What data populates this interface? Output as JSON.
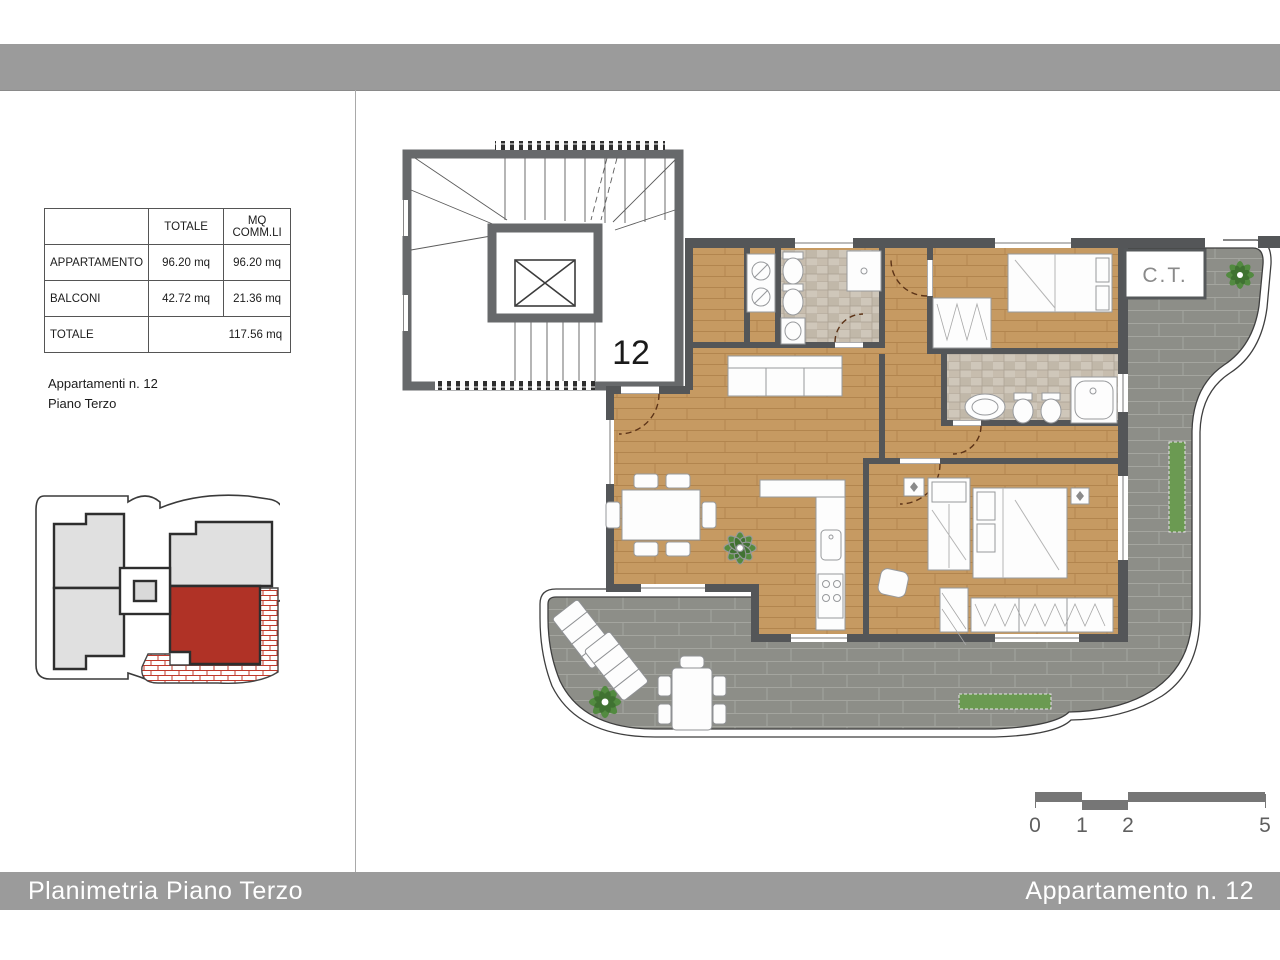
{
  "left_panel": {
    "area_table": {
      "col_headers": [
        "",
        "TOTALE",
        "MQ COMM.LI"
      ],
      "rows": [
        {
          "label": "APPARTAMENTO",
          "totale": "96.20 mq",
          "comm": "96.20 mq"
        },
        {
          "label": "BALCONI",
          "totale": "42.72 mq",
          "comm": "21.36 mq"
        },
        {
          "label": "TOTALE",
          "totale_comm": "117.56 mq"
        }
      ]
    },
    "notes": {
      "line1": "Appartamenti n. 12",
      "line2": "Piano Terzo"
    }
  },
  "plan": {
    "unit_label": "12",
    "ct_label": "C.T.",
    "scale_bar": {
      "labels": [
        "0",
        "1",
        "2",
        "5"
      ]
    }
  },
  "footer": {
    "left": "Planimetria Piano Terzo",
    "right": "Appartamento n. 12"
  },
  "colors": {
    "title_bar": "#9b9b9b",
    "wall": "#545658",
    "wood_floor": "#c69a62",
    "terrace_paver": "#8d8e88",
    "bath_tile": "#cfc7ba",
    "keyplan_highlight_red": "#b03226",
    "plant_green": "#4f8a3d",
    "scale_bar_gray": "#767676"
  }
}
